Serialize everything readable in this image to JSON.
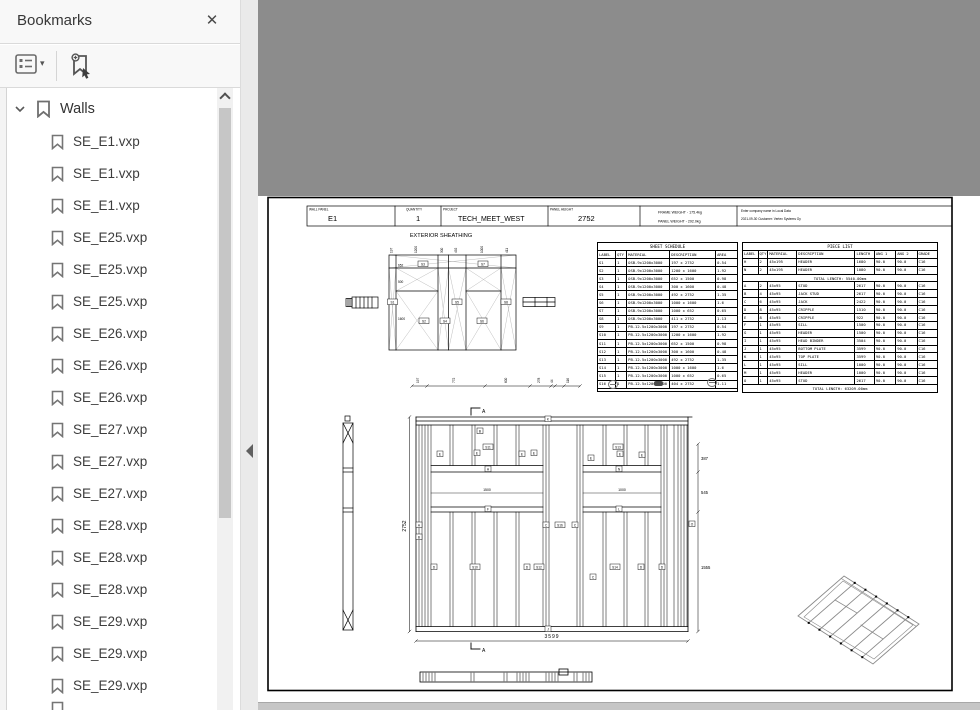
{
  "panel": {
    "title": "Bookmarks",
    "root_label": "Walls",
    "items": [
      "SE_E1.vxp",
      "SE_E1.vxp",
      "SE_E1.vxp",
      "SE_E25.vxp",
      "SE_E25.vxp",
      "SE_E25.vxp",
      "SE_E26.vxp",
      "SE_E26.vxp",
      "SE_E26.vxp",
      "SE_E27.vxp",
      "SE_E27.vxp",
      "SE_E27.vxp",
      "SE_E28.vxp",
      "SE_E28.vxp",
      "SE_E28.vxp",
      "SE_E29.vxp",
      "SE_E29.vxp",
      "SE_E29.vxp"
    ]
  },
  "icons": {
    "close": "✕",
    "options_caret": "▾",
    "icon_names": [
      "options-icon",
      "new-bookmark-icon",
      "chevron-down-icon",
      "bookmark-icon",
      "scroll-up-icon",
      "collapse-left-icon",
      "close-icon"
    ]
  },
  "viewer": {
    "canvas_color": "#8c8c8c"
  },
  "drawing": {
    "title_block": {
      "wall_panel_label": "WALL PANEL",
      "wall_panel_value": "E1",
      "quantity_label": "QUANTITY",
      "quantity_value": "1",
      "project_label": "PROJECT",
      "project_value": "TECH_MEET_WEST",
      "panel_height_label": "PANEL HEIGHT",
      "panel_height_value": "2752",
      "frame_weight": "FRAME WEIGHT - 175.4kg",
      "panel_weight": "PANEL WEIGHT - 292.0kg",
      "company_line1": "Enter company name in Local Data",
      "company_line2": "2021-09-30   Customer: Vertex Systems Oy"
    },
    "sheathing_label": "EXTERIOR SHEATHING",
    "sheet_labels": [
      "S1",
      "S2",
      "S3",
      "S4",
      "S5",
      "S6",
      "S7",
      "S8"
    ],
    "side_dims": [
      "652",
      "500",
      "1600"
    ],
    "top_dims": [
      "197",
      "1200",
      "300",
      "492",
      "1000",
      "411"
    ],
    "bottom_dims": [
      "197",
      "772",
      "600",
      "278",
      "44",
      "116"
    ],
    "dims": {
      "panel_height": "2752",
      "panel_width": "3599",
      "right": [
        "387",
        "545",
        "1555"
      ],
      "left_window": "1500",
      "right_window": "1000",
      "section": "A"
    },
    "elev_labels": [
      "K",
      "B",
      "S11",
      "S13",
      "E",
      "E",
      "E",
      "E",
      "E",
      "E",
      "E",
      "H",
      "N",
      "F",
      "L",
      "A",
      "B",
      "C",
      "S16",
      "C",
      "D",
      "S10",
      "D",
      "S12",
      "C",
      "S14",
      "D",
      "D",
      "J",
      "O"
    ],
    "sheet_schedule": {
      "title": "SHEET SCHEDULE",
      "headers": [
        [
          "LABEL",
          "QTY",
          "MATERIAL",
          "DESCRIPTION",
          "AREA"
        ]
      ],
      "rows": [
        [
          "S1",
          "1",
          "OSB-9x1200x3000",
          "197 x 2752",
          "0.54"
        ],
        [
          "S2",
          "1",
          "OSB-9x1200x3000",
          "1200 x 1600",
          "1.92"
        ],
        [
          "S3",
          "1",
          "OSB-9x1200x3000",
          "652 x 1500",
          "0.98"
        ],
        [
          "S4",
          "1",
          "OSB-9x1200x3000",
          "300 x 1600",
          "0.48"
        ],
        [
          "S5",
          "1",
          "OSB-9x1200x3000",
          "492 x 2752",
          "1.35"
        ],
        [
          "S6",
          "1",
          "OSB-9x1200x3000",
          "1000 x 1600",
          "1.6"
        ],
        [
          "S7",
          "1",
          "OSB-9x1200x3000",
          "1000 x 652",
          "0.65"
        ],
        [
          "S8",
          "1",
          "OSB-9x1200x3000",
          "411 x 2752",
          "1.13"
        ],
        [
          "S9",
          "1",
          "PB-12.5x1200x3000",
          "197 x 2752",
          "0.54"
        ],
        [
          "S10",
          "1",
          "PB-12.5x1200x3000",
          "1200 x 1600",
          "1.92"
        ],
        [
          "S11",
          "1",
          "PB-12.5x1200x3000",
          "652 x 1500",
          "0.98"
        ],
        [
          "S12",
          "1",
          "PB-12.5x1200x3000",
          "300 x 1600",
          "0.48"
        ],
        [
          "S13",
          "1",
          "PB-12.5x1200x3000",
          "492 x 2752",
          "1.35"
        ],
        [
          "S14",
          "1",
          "PB-12.5x1200x3000",
          "1000 x 1600",
          "1.6"
        ],
        [
          "S15",
          "1",
          "PB-12.5x1200x3000",
          "1000 x 652",
          "0.65"
        ],
        [
          "S16",
          "1",
          "PB-12.5x1200x3000",
          "404 x 2752",
          "1.11"
        ]
      ],
      "summary": "Summary:   17.0m2"
    },
    "piece_list": {
      "title": "PIECE LIST",
      "headers": [
        [
          "LABEL",
          "QTY",
          "MATERIAL",
          "DESCRIPTION",
          "LENGTH",
          "ANG 1",
          "ANG 2",
          "GRADE"
        ]
      ],
      "rows_top": [
        [
          "H",
          "2",
          "45x195",
          "HEADER",
          "1680",
          "90.0",
          "90.0",
          "C16"
        ],
        [
          "N",
          "2",
          "45x195",
          "HEADER",
          "1080",
          "90.0",
          "90.0",
          "C16"
        ]
      ],
      "total_top": "TOTAL LENGTH:  5540.00mm",
      "rows_main": [
        [
          "A",
          "2",
          "45x95",
          "STUD",
          "2617",
          "90.0",
          "90.0",
          "C16"
        ],
        [
          "B",
          "4",
          "45x95",
          "JACK STUD",
          "2617",
          "90.0",
          "90.0",
          "C16"
        ],
        [
          "C",
          "6",
          "45x95",
          "JACK",
          "2422",
          "90.0",
          "90.0",
          "C16"
        ],
        [
          "D",
          "8",
          "45x95",
          "CRIPPLE",
          "1510",
          "90.0",
          "90.0",
          "C16"
        ],
        [
          "E",
          "8",
          "45x95",
          "CRIPPLE",
          "922",
          "90.0",
          "90.0",
          "C16"
        ],
        [
          "F",
          "1",
          "45x95",
          "SILL",
          "1500",
          "90.0",
          "90.0",
          "C16"
        ],
        [
          "G",
          "1",
          "45x95",
          "HEADER",
          "1500",
          "90.0",
          "90.0",
          "C16"
        ],
        [
          "I",
          "1",
          "45x95",
          "HEAD BINDER",
          "3504",
          "90.0",
          "90.0",
          "C16"
        ],
        [
          "J",
          "1",
          "45x95",
          "BOTTOM PLATE",
          "3599",
          "90.0",
          "90.0",
          "C16"
        ],
        [
          "K",
          "1",
          "45x95",
          "TOP PLATE",
          "3599",
          "90.0",
          "90.0",
          "C16"
        ],
        [
          "L",
          "1",
          "45x95",
          "SILL",
          "1000",
          "90.0",
          "90.0",
          "C16"
        ],
        [
          "M",
          "1",
          "45x95",
          "HEADER",
          "1000",
          "90.0",
          "90.0",
          "C16"
        ],
        [
          "O",
          "1",
          "45x95",
          "STUD",
          "2617",
          "90.0",
          "90.0",
          "C16"
        ]
      ],
      "total_main": "TOTAL LENGTH:  63209.00mm"
    }
  }
}
